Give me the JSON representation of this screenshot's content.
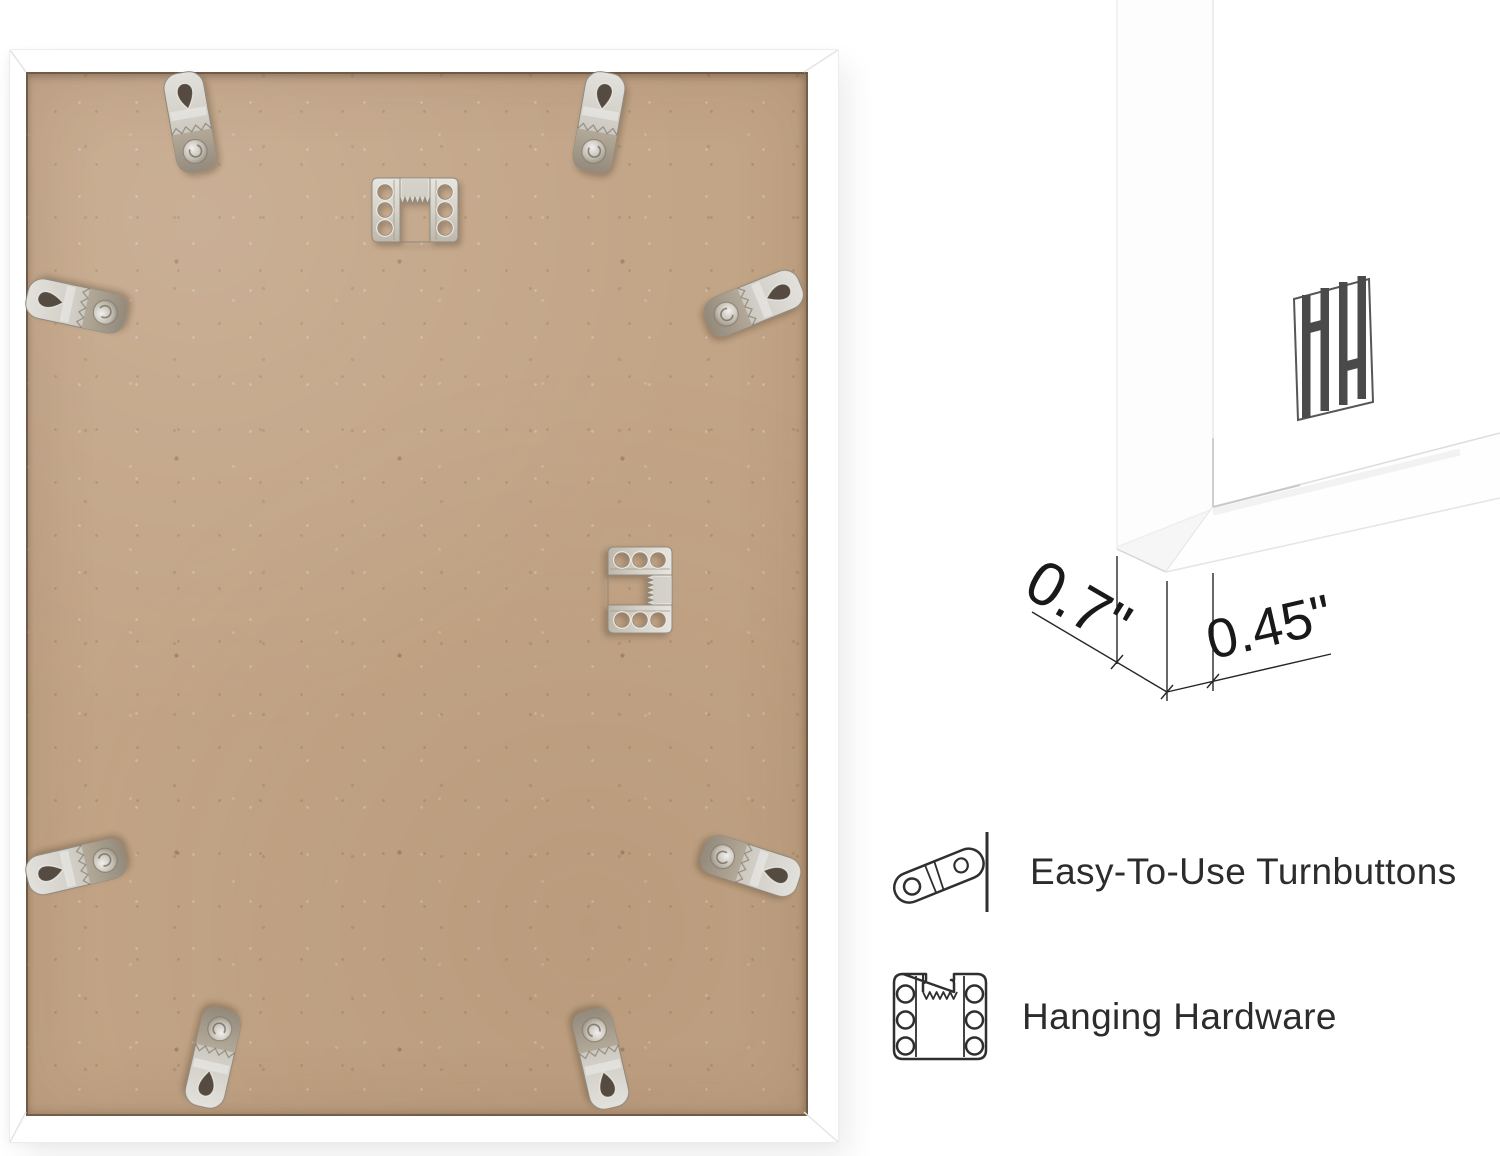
{
  "page": {
    "background": "#ffffff"
  },
  "back_view": {
    "hardware": {
      "turnbutton_count": 8,
      "sawtooth_hanger_count": 2,
      "board_material_color": "#c2a486",
      "frame_color": "#ffffff",
      "metal_color": "#cdc9c0"
    }
  },
  "closeup": {
    "logo_monogram": "HH",
    "dimensions": {
      "depth": "0.7\"",
      "face_width": "0.45\""
    }
  },
  "features": [
    {
      "icon": "turnbutton-icon",
      "label": "Easy-To-Use Turnbuttons"
    },
    {
      "icon": "hanging-hardware-icon",
      "label": "Hanging Hardware"
    }
  ]
}
